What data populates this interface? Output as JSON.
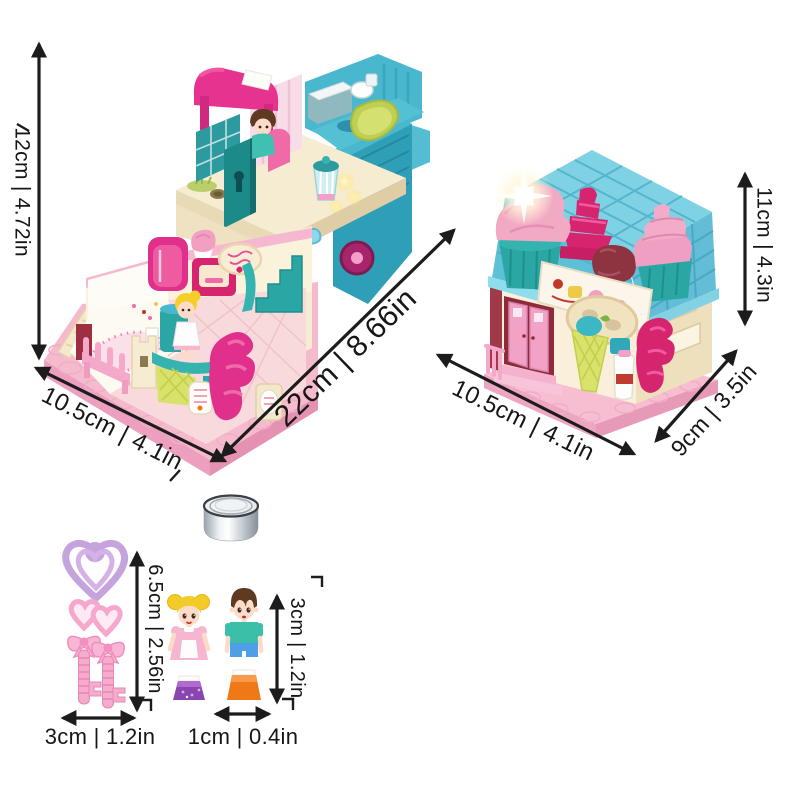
{
  "page": {
    "background": "#ffffff",
    "arrow_color": "#1c1c1c",
    "text_color": "#161616"
  },
  "items": {
    "open_playhouse": "open-two-level-playhouse",
    "closed_playhouse": "closed-dessert-house",
    "battery": "button-cell-battery",
    "keys": "pink-toy-keys-charm",
    "girl_doll": "girl-mini-doll",
    "boy_doll": "boy-mini-doll"
  },
  "measurements": {
    "open_house_height": "12cm | 4.72in",
    "open_house_depth": "10.5cm | 4.1in",
    "open_house_width": "22cm | 8.66in",
    "closed_house_width": "10.5cm | 4.1in",
    "closed_house_depth": "9cm | 3.5in",
    "closed_house_height": "11cm | 4.3in",
    "keys_height": "6.5cm | 2.56in",
    "keys_width": "3cm | 1.2in",
    "doll_height": "3cm | 1.2in",
    "doll_width": "1cm | 0.4in"
  },
  "palette": {
    "pink_base": "#f6bacd",
    "magenta": "#e0308c",
    "deep_pink": "#d6246e",
    "teal": "#2aa7a4",
    "roof_blue": "#6ec8de",
    "cream": "#f6ecd2",
    "lime": "#d8e26a",
    "lavender": "#c5a3dd",
    "doll_purple": "#8a46b0",
    "doll_orange": "#ef7916",
    "boy_teal": "#3bbfa9",
    "silver": "#c3cad1"
  }
}
